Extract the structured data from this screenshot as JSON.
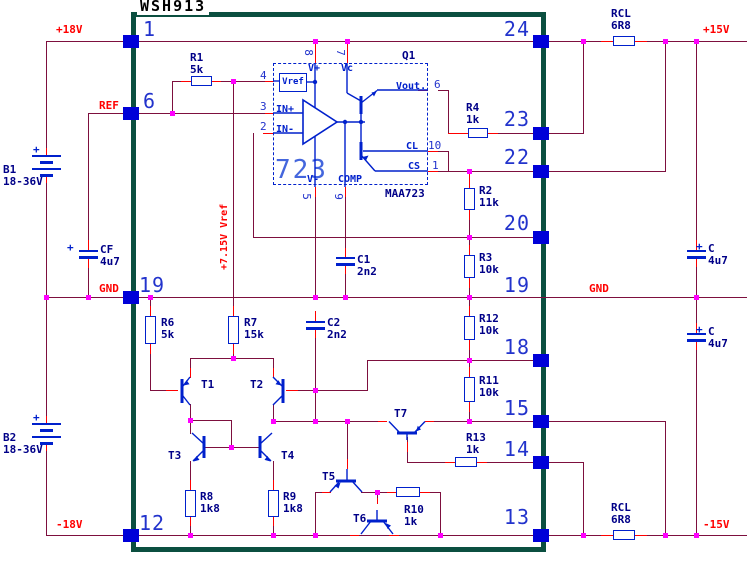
{
  "title": "WSH913",
  "rails": {
    "p18v": "+18V",
    "ref": "REF",
    "gnd_left": "GND",
    "n18v": "-18V",
    "p15v": "+15V",
    "gnd_right": "GND",
    "n15v": "-15V",
    "vref_rail": "+7.15V Vref"
  },
  "pins": {
    "l1": "1",
    "l6": "6",
    "l19": "19",
    "l12": "12",
    "r24": "24",
    "r23": "23",
    "r22": "22",
    "r20": "20",
    "r19": "19",
    "r18": "18",
    "r15": "15",
    "r14": "14",
    "r13": "13"
  },
  "parts": {
    "r1": {
      "ref": "R1",
      "val": "5k"
    },
    "r2": {
      "ref": "R2",
      "val": "11k"
    },
    "r3": {
      "ref": "R3",
      "val": "10k"
    },
    "r4": {
      "ref": "R4",
      "val": "1k"
    },
    "r6": {
      "ref": "R6",
      "val": "5k"
    },
    "r7": {
      "ref": "R7",
      "val": "15k"
    },
    "r8": {
      "ref": "R8",
      "val": "1k8"
    },
    "r9": {
      "ref": "R9",
      "val": "1k8"
    },
    "r10": {
      "ref": "R10",
      "val": "1k"
    },
    "r11": {
      "ref": "R11",
      "val": "10k"
    },
    "r12": {
      "ref": "R12",
      "val": "10k"
    },
    "r13": {
      "ref": "R13",
      "val": "1k"
    },
    "rcl_top": {
      "ref": "RCL",
      "val": "6R8"
    },
    "rcl_bot": {
      "ref": "RCL",
      "val": "6R8"
    },
    "c1": {
      "ref": "C1",
      "val": "2n2"
    },
    "c2": {
      "ref": "C2",
      "val": "2n2"
    },
    "cf": {
      "ref": "CF",
      "val": "4u7",
      "plus": "+"
    },
    "c_pos": {
      "ref": "C",
      "val": "4u7",
      "plus": "+"
    },
    "c_neg": {
      "ref": "C",
      "val": "4u7",
      "plus": "+"
    },
    "b1": {
      "ref": "B1",
      "val": "18-36V",
      "plus": "+"
    },
    "b2": {
      "ref": "B2",
      "val": "18-36V",
      "plus": "+"
    },
    "t1": "T1",
    "t2": "T2",
    "t3": "T3",
    "t4": "T4",
    "t5": "T5",
    "t6": "T6",
    "t7": "T7"
  },
  "ic723": {
    "big": "723",
    "part": "MAA723",
    "q1": "Q1",
    "vref": "Vref",
    "vplus": "V+",
    "vc": "Vc",
    "vminus": "V-",
    "comp": "COMP",
    "inp": "IN+",
    "inn": "IN-",
    "vout": "Vout.",
    "cl": "CL",
    "cs": "CS",
    "p8": "8",
    "p7": "7",
    "p5": "5",
    "p9": "9",
    "p4": "4",
    "p3": "3",
    "p2": "2",
    "p6": "6",
    "p10": "10",
    "p1": "1"
  }
}
